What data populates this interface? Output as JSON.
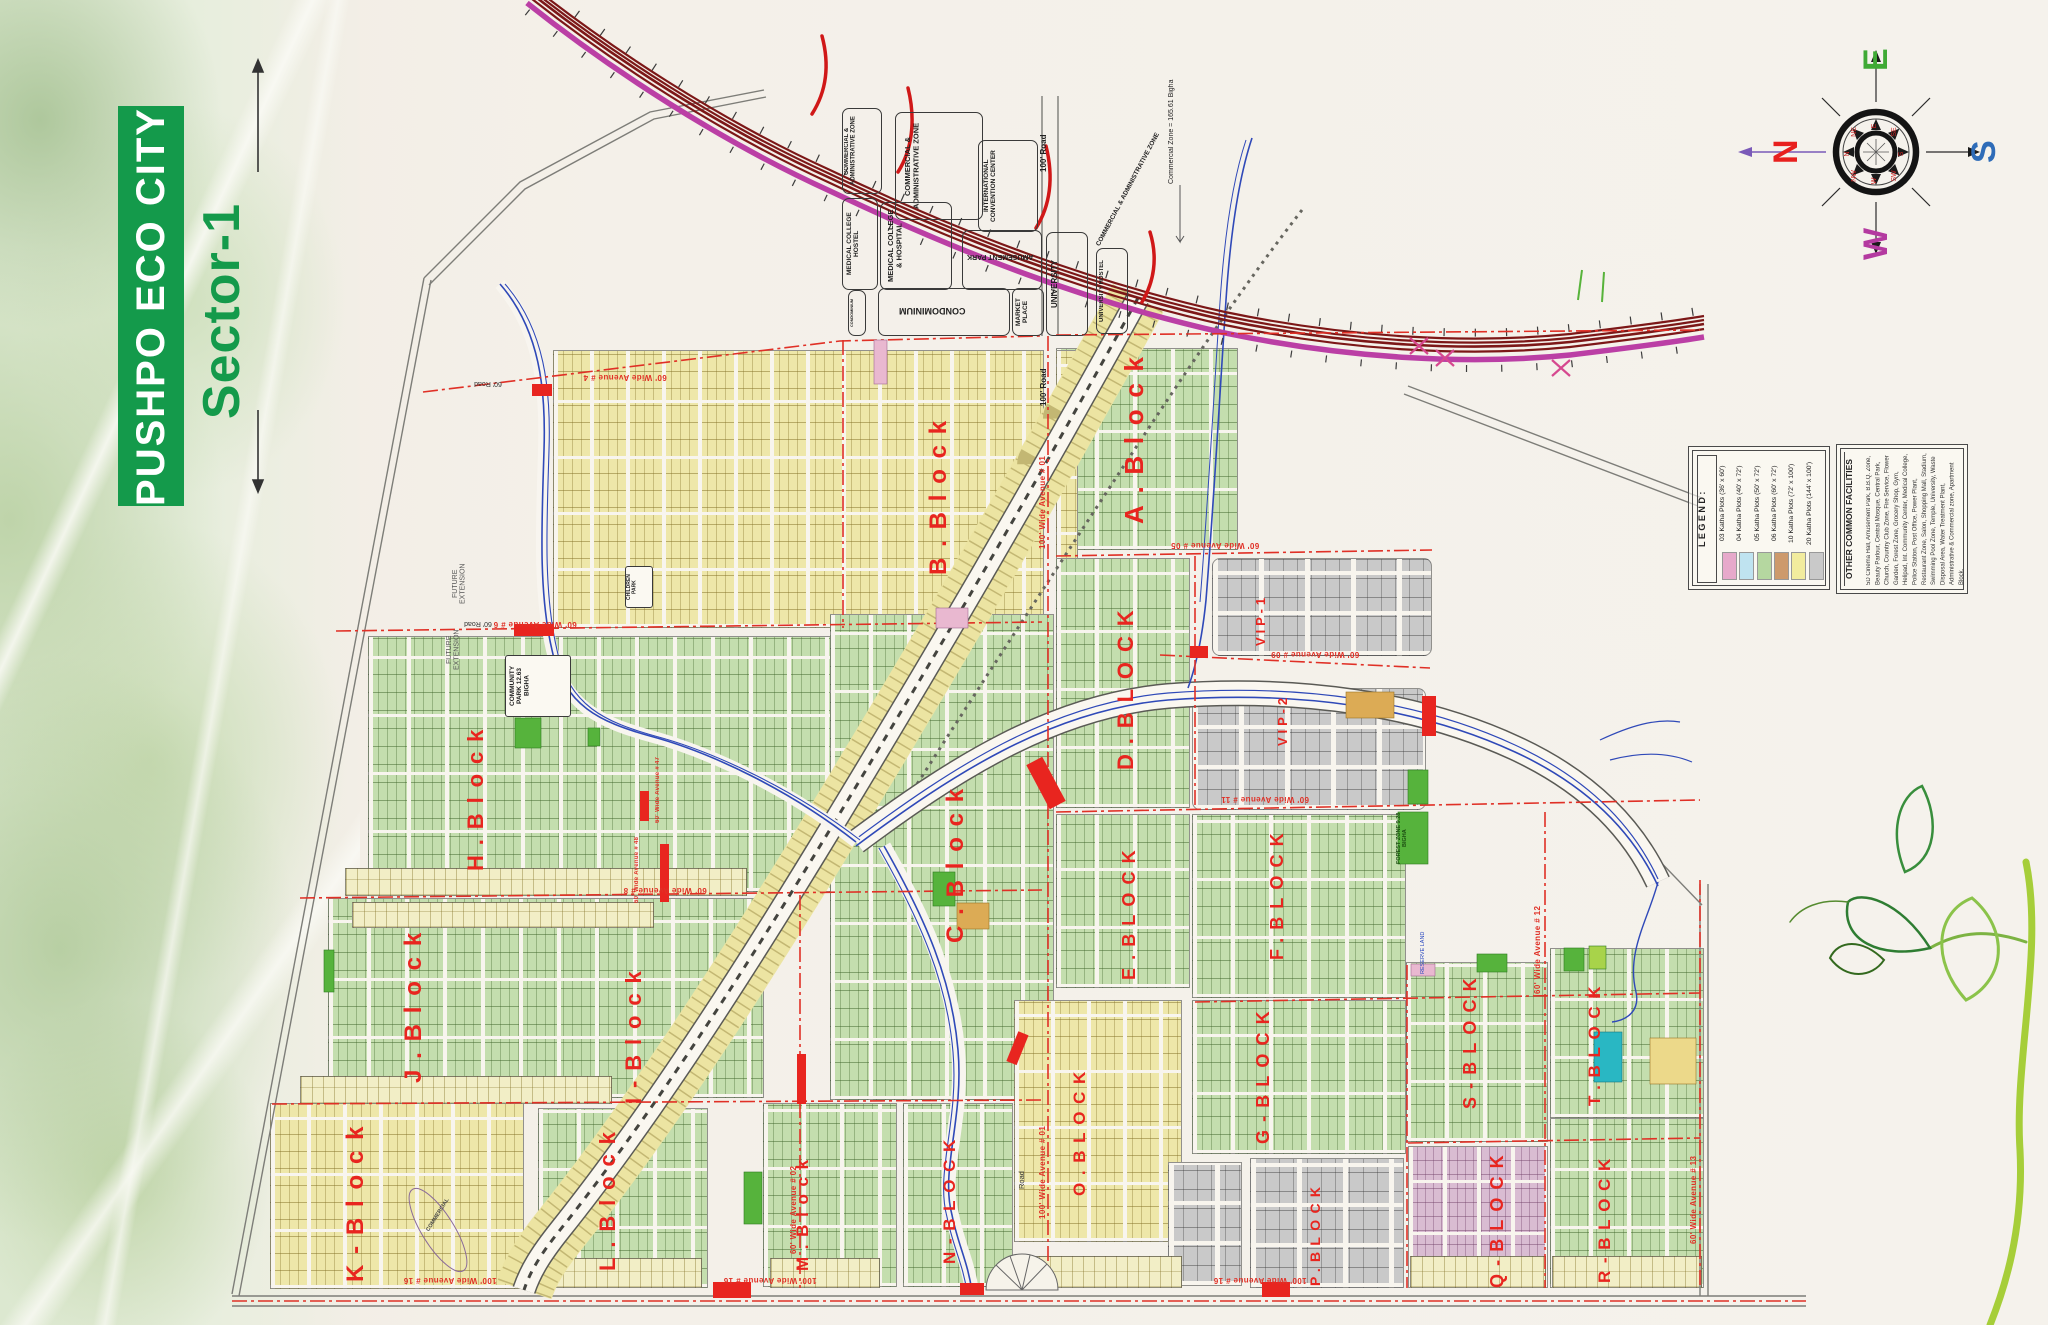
{
  "branding": {
    "title": "PUSHPO ECO CITY",
    "sector": "Sector-1",
    "accent": "#149a4b"
  },
  "compass": {
    "north": "N",
    "east": "E",
    "south": "S",
    "west": "W",
    "north_color": "#e8201e",
    "east_color": "#3faa35",
    "south_color": "#2e6cb8",
    "west_color": "#b43aa0",
    "inner": [
      "E",
      "SE",
      "S",
      "SW",
      "W",
      "NW",
      "N",
      "NE"
    ]
  },
  "legend": {
    "title": "L E G E N D :",
    "items": [
      {
        "label": "03 Katha Plots (36' x 60')",
        "color": "#e7a9cb"
      },
      {
        "label": "04 Katha Plots (40' x 72')",
        "color": "#bfe3f0"
      },
      {
        "label": "05 Katha Plots (50' x 72')",
        "color": "#b5d7a0"
      },
      {
        "label": "06 Katha Plots (60' x 72')",
        "color": "#cd9a6c"
      },
      {
        "label": "10 Katha Plots (72' x 100')",
        "color": "#f2ec9e"
      },
      {
        "label": "20 Katha Plots (144' x 100')",
        "color": "#c9c9c9"
      }
    ]
  },
  "facilities": {
    "title": "OTHER COMMON FACILITIES",
    "text": "5D Cinema Hall, Amusement Park, B.B.Q. Zone, Beauty Parlour, Central Mosque, Central Park, Church, Country Club Zone, Fire Service, Flower Garden, Forest Zone, Grocery Shop, Gym, Helipad, Int. Community Center, Medical College, Police Station, Post Office, Power Plant, Restaurant Zone, Salon, Shopping Mall, Stadium, Swimming Pool Zone, Temple, University, Waste Disposal Area, Water Treatment Plant, Administrative & Commercial zone, Apartment Block."
  },
  "map": {
    "zones": {
      "ca": "COMMERCIAL & ADMINISTRATIVE ZONE",
      "icc": "INTERNATIONAL CONVENTION CENTER",
      "mch": "MEDICAL COLLEGE HOSTEL",
      "mc": "MEDICAL COLLEGE & HOSPITAL",
      "amusement": "AMUSEMENT PARK",
      "condo": "CONDOMINIUM",
      "market": "MARKET PLACE",
      "university": "UNIVERSITY",
      "university_hostel": "UNIVERSITY HOSTEL",
      "commercial_zone_note": "Commercial Zone = 165.61 Bigha",
      "road100": "100' Road",
      "road60": "60' Road",
      "future": "FUTURE EXTENSION",
      "community_park": "COMMUNITY PARK 12.63 BIGHA",
      "forest": "FOREST ZONE 9.28 BIGHA",
      "children_park": "CHILDREN PARK",
      "commercial": "COMMERCIAL",
      "reserve": "RESERVE LAND",
      "road": "Road"
    },
    "blocks": {
      "a": "A.Block",
      "b": "B.Block",
      "c": "C.Block",
      "d": "D.BLOCK",
      "e": "E.BLOCK",
      "f": "F.BLOCK",
      "g": "G-BLOCK",
      "h": "H.Block",
      "i": "I-Block",
      "j": "J.Block",
      "k": "K-Block",
      "l": "L.Block",
      "m": "M.Block",
      "n": "N-BLOCK",
      "o": "O.BLOCK",
      "p": "P.BLOCK",
      "q": "Q-BLOCK",
      "r": "R-BLOCK",
      "s": "S-BLOCK",
      "t": "T.BLOCK",
      "vip1": "VIP-1",
      "vip2": "VIP-2"
    },
    "avenues": {
      "a16": "100' Wide Avenue # 16",
      "a01": "100' Wide Avenue # 01",
      "a02": "60' Wide Avenue # 02",
      "a04": "60' Wide Avenue # 4",
      "a05": "60' Wide Avenue # 05",
      "a06": "60' Wide Avenue # 6",
      "a08": "60' Wide Avenue # 8",
      "a09": "60' Wide Avenue # 09",
      "a11": "60' Wide Avenue # 11",
      "a12": "60' Wide Avenue # 12",
      "a13": "60' Wide Avenue # 13",
      "a47": "60' Wide Avenue # 47",
      "a48": "60' Wide Avenue # 48"
    }
  }
}
